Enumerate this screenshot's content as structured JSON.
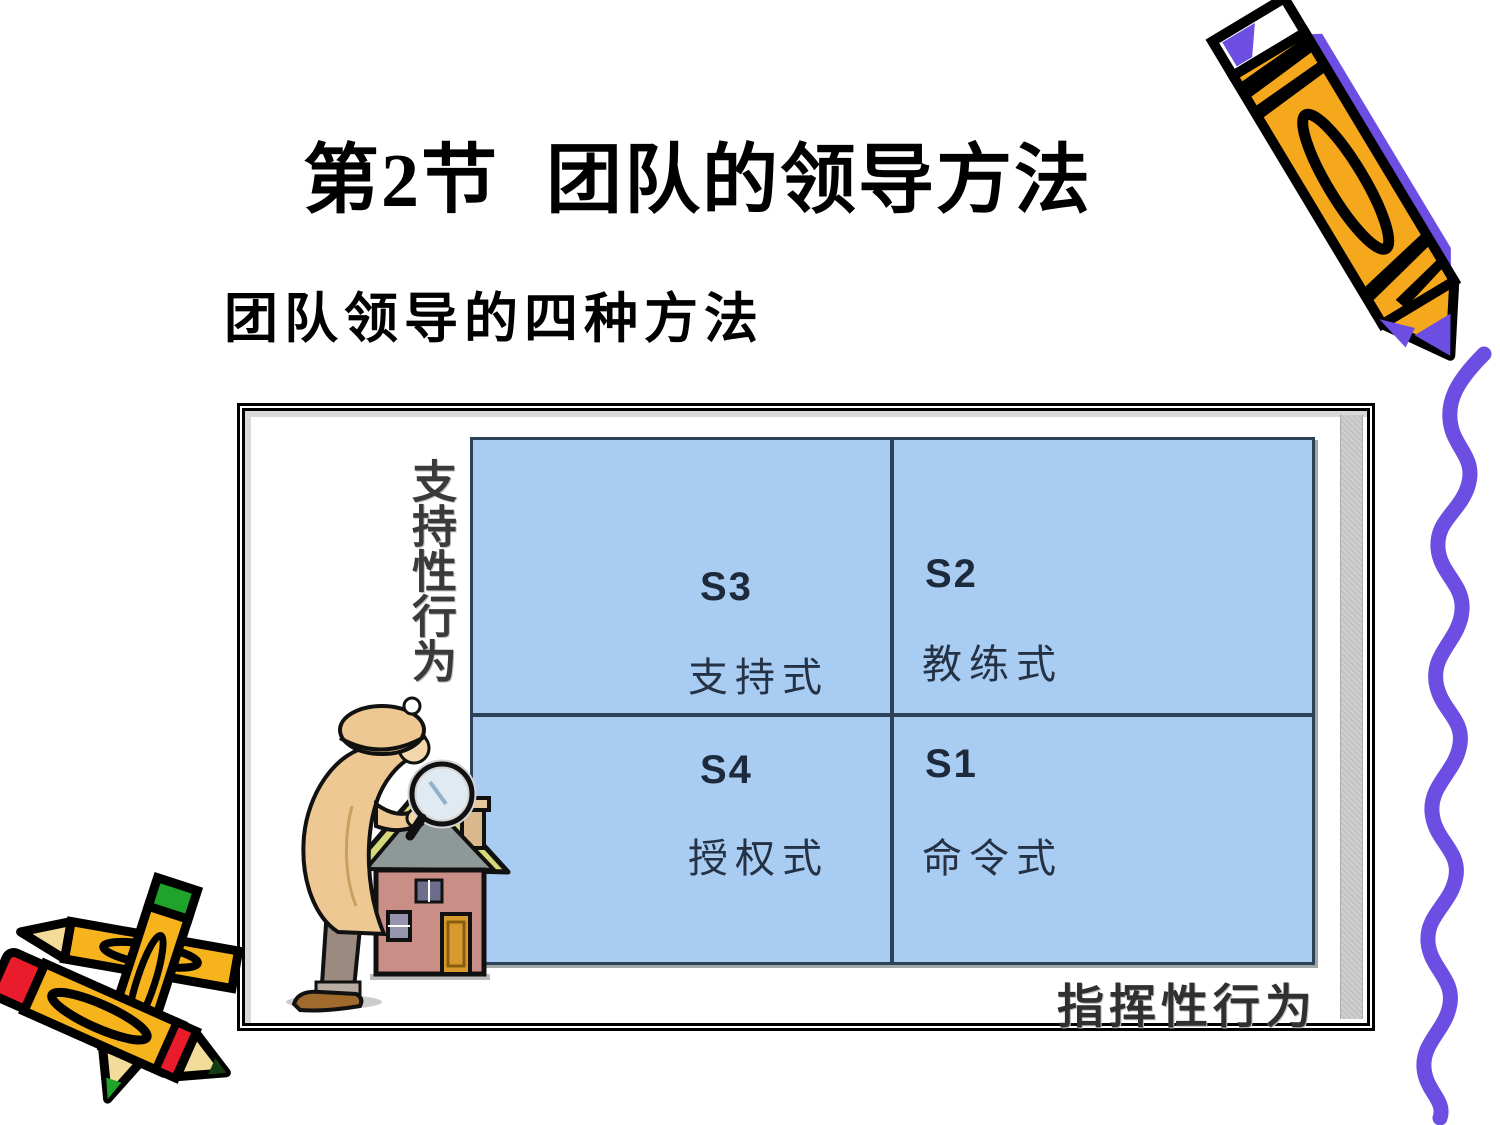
{
  "slide": {
    "title": "第2节 团队的领导方法",
    "subtitle": "团队领导的四种方法"
  },
  "diagram": {
    "y_axis_label": "支持性行为",
    "x_axis_label": "指挥性行为",
    "quadrants": {
      "top_left": {
        "code": "S3",
        "label": "支持式"
      },
      "top_right": {
        "code": "S2",
        "label": "教练式"
      },
      "bottom_left": {
        "code": "S4",
        "label": "授权式"
      },
      "bottom_right": {
        "code": "S1",
        "label": "命令式"
      }
    },
    "colors": {
      "cell_bg": "#a9cdf2",
      "grid_line": "#2e4257",
      "frame_border": "#000000",
      "scrollbar_gray": "#c9c9c9"
    }
  },
  "decorations": {
    "pencil_top_right": {
      "icon": "pencil-icon",
      "body_color": "#f6a81c",
      "accent_color": "#6c4fe2"
    },
    "squiggle_line": {
      "icon": "squiggle-line",
      "color": "#6c4fe2"
    },
    "crossed_pencils": {
      "icon": "crossed-pencils-icon",
      "body_color": "#f6b31c",
      "eraser_red": "#ea1c2c",
      "eraser_green": "#1fa32b"
    },
    "detective_house": {
      "icon": "detective-house-icon",
      "coat_color": "#eec893",
      "house_color": "#c98e85"
    }
  }
}
